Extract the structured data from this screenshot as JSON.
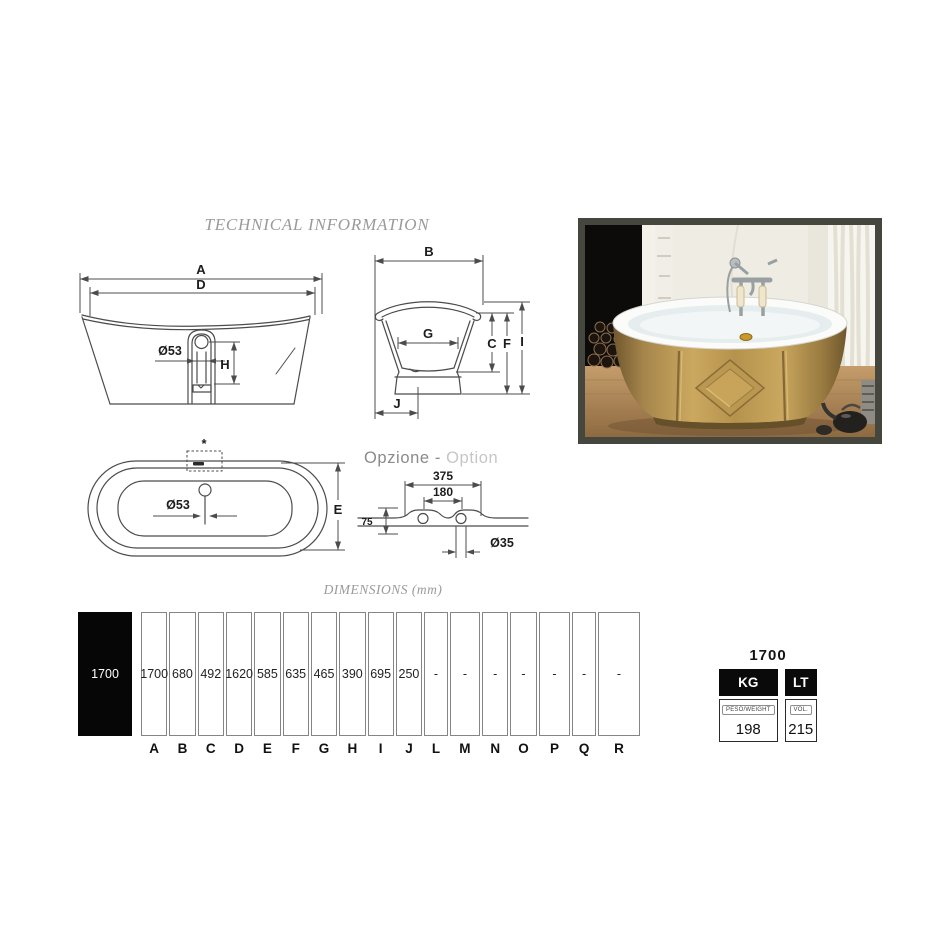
{
  "page": {
    "title": "TECHNICAL INFORMATION",
    "dimensions_heading": "DIMENSIONS (mm)",
    "option_heading_it": "Opzione -",
    "option_heading_en": "Option"
  },
  "front_view": {
    "dim_a": "A",
    "dim_d": "D",
    "drain_diameter": "Ø53",
    "dim_h": "H"
  },
  "side_view": {
    "dim_b": "B",
    "dim_g": "G",
    "dim_c": "C",
    "dim_f": "F",
    "dim_i": "I",
    "dim_j": "J"
  },
  "top_view": {
    "footnote_marker": "*",
    "drain_diameter": "Ø53",
    "dim_e": "E"
  },
  "option_view": {
    "dim_width_outer": "375",
    "dim_width_inner": "180",
    "dim_height": "75",
    "hole_diameter": "Ø35"
  },
  "dimensions_table": {
    "model": "1700",
    "columns": [
      {
        "letter": "A",
        "value": "1700"
      },
      {
        "letter": "B",
        "value": "680"
      },
      {
        "letter": "C",
        "value": "492"
      },
      {
        "letter": "D",
        "value": "1620"
      },
      {
        "letter": "E",
        "value": "585"
      },
      {
        "letter": "F",
        "value": "635"
      },
      {
        "letter": "G",
        "value": "465"
      },
      {
        "letter": "H",
        "value": "390"
      },
      {
        "letter": "I",
        "value": "695"
      },
      {
        "letter": "J",
        "value": "250"
      },
      {
        "letter": "L",
        "value": "-"
      },
      {
        "letter": "M",
        "value": "-"
      },
      {
        "letter": "N",
        "value": "-"
      },
      {
        "letter": "O",
        "value": "-"
      },
      {
        "letter": "P",
        "value": "-"
      },
      {
        "letter": "Q",
        "value": "-"
      },
      {
        "letter": "R",
        "value": "-"
      }
    ]
  },
  "spec_box": {
    "model": "1700",
    "weight_unit": "KG",
    "volume_unit": "LT",
    "weight_label": "PESO/WEIGHT",
    "volume_label": "VOL.",
    "weight_value": "198",
    "volume_value": "215"
  },
  "colors": {
    "tub_gold": "#b8954e",
    "photo_frame": "#45463e",
    "drawing_line": "#4c4c4c",
    "muted_text": "#9a9a9a"
  }
}
